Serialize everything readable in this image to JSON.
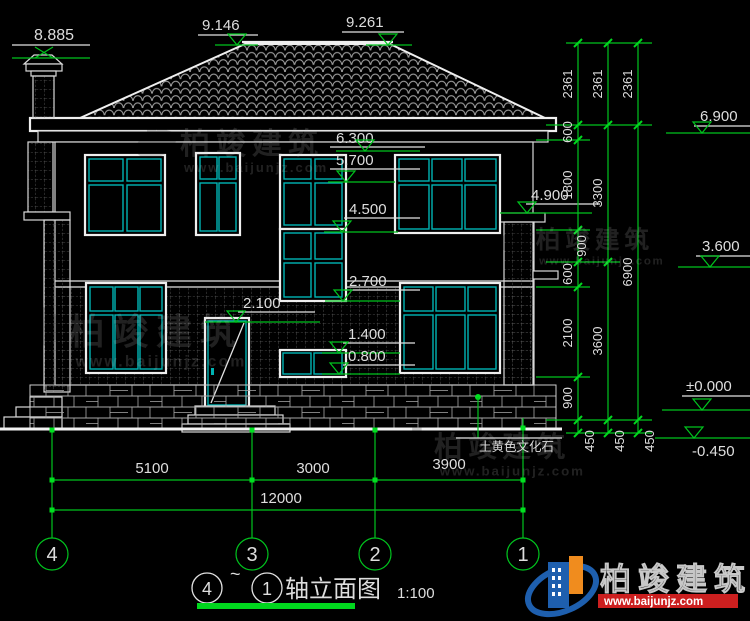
{
  "title": {
    "from": "4",
    "tilde": "~",
    "to": "1",
    "name": "轴立面图",
    "scale": "1:100"
  },
  "axes": {
    "a4": "4",
    "a3": "3",
    "a2": "2",
    "a1": "1"
  },
  "elev": {
    "e8885": "8.885",
    "e9146": "9.146",
    "e9261": "9.261",
    "e6900": "6.900",
    "e6300": "6.300",
    "e5700": "5.700",
    "e4500": "4.500",
    "e4900": "4.900",
    "e3600": "3.600",
    "e2700": "2.700",
    "e2100": "2.100",
    "e1400": "1.400",
    "e0800": "0.800",
    "e0000": "±0.000",
    "em0450": "-0.450"
  },
  "rdim": {
    "r2361": "2361",
    "c1": [
      "600",
      "1800",
      "900",
      "600",
      "2100",
      "900"
    ],
    "c2": [
      "3300",
      "3600"
    ],
    "c3": [
      "6900"
    ],
    "r450": "450"
  },
  "bdim": {
    "s1": "5100",
    "s2": "3000",
    "s3": "3900",
    "total": "12000"
  },
  "note": {
    "stone": "土黄色文化石"
  },
  "brand": {
    "name": "柏竣建筑",
    "site": "www.baijunjz.com"
  },
  "colors": {
    "background": "#000000",
    "line": "#e2e2e2",
    "dimension": "#00c41e",
    "frame": "#00b4b4",
    "logo_blue": "#1e5fae",
    "logo_orange": "#f08c1e",
    "logo_red": "#cc1f1f"
  }
}
